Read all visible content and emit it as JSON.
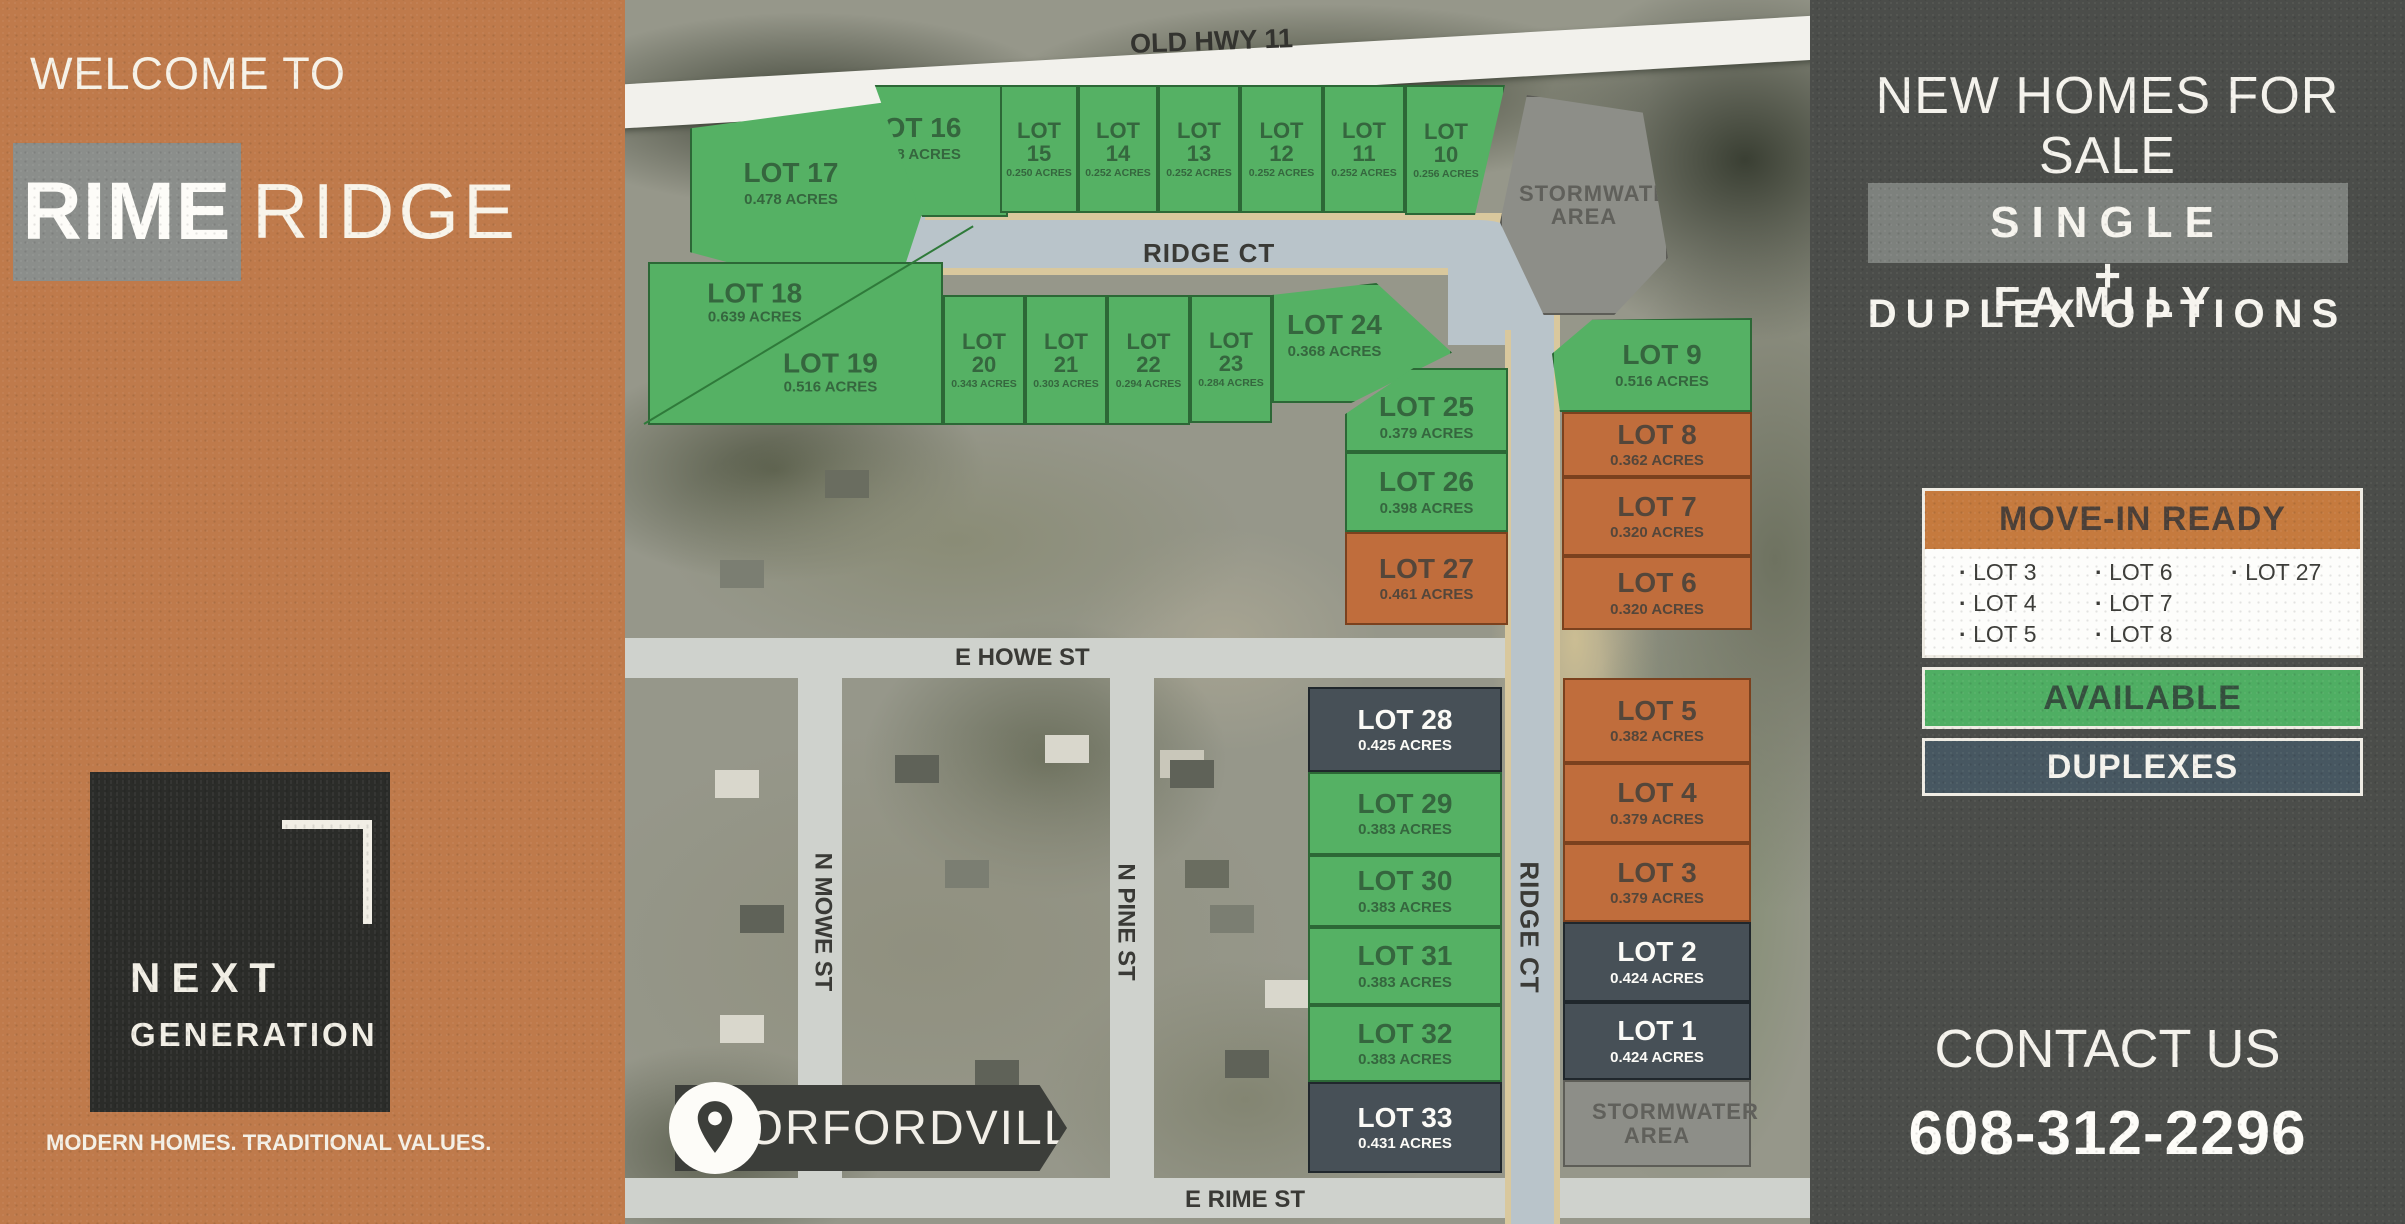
{
  "left_panel": {
    "welcome": "WELCOME TO",
    "brand_primary": "RIME",
    "brand_secondary": "RIDGE",
    "logo_line1": "NEXT",
    "logo_line2": "GENERATION",
    "tagline": "MODERN HOMES. TRADITIONAL VALUES."
  },
  "right_panel": {
    "headline": "NEW HOMES FOR SALE",
    "subhead_primary": "SINGLE FAMILY",
    "subhead_plus": "+",
    "subhead_secondary": "DUPLEX OPTIONS",
    "legend": {
      "move_in_ready": {
        "label": "MOVE-IN READY",
        "column1": [
          "LOT 3",
          "LOT 4",
          "LOT 5"
        ],
        "column2": [
          "LOT 6",
          "LOT 7",
          "LOT 8"
        ],
        "column3": [
          "LOT 27"
        ]
      },
      "available_label": "AVAILABLE",
      "duplexes_label": "DUPLEXES"
    },
    "contact": {
      "label": "CONTACT US",
      "phone": "608-312-2296"
    }
  },
  "map": {
    "streets": {
      "old_hwy": "OLD HWY 11",
      "ridge_ct_top": "RIDGE CT",
      "ridge_ct_side": "RIDGE CT",
      "e_howe": "E HOWE ST",
      "n_mowe": "N MOWE ST",
      "n_pine": "N PINE ST",
      "e_rime": "E RIME ST"
    },
    "town_badge": "ORFORDVILLE",
    "stormwater_top": "STORMWATER AREA",
    "stormwater_bottom": "STORMWATER AREA",
    "lots": {
      "lot1": {
        "name": "LOT 1",
        "acres": "0.424 ACRES",
        "status": "duplex"
      },
      "lot2": {
        "name": "LOT 2",
        "acres": "0.424 ACRES",
        "status": "duplex"
      },
      "lot3": {
        "name": "LOT 3",
        "acres": "0.379 ACRES",
        "status": "move-in-ready"
      },
      "lot4": {
        "name": "LOT 4",
        "acres": "0.379 ACRES",
        "status": "move-in-ready"
      },
      "lot5": {
        "name": "LOT 5",
        "acres": "0.382 ACRES",
        "status": "move-in-ready"
      },
      "lot6": {
        "name": "LOT 6",
        "acres": "0.320 ACRES",
        "status": "move-in-ready"
      },
      "lot7": {
        "name": "LOT 7",
        "acres": "0.320 ACRES",
        "status": "move-in-ready"
      },
      "lot8": {
        "name": "LOT 8",
        "acres": "0.362 ACRES",
        "status": "move-in-ready"
      },
      "lot9": {
        "name": "LOT 9",
        "acres": "0.516 ACRES",
        "status": "available"
      },
      "lot10": {
        "name": "LOT 10",
        "acres": "0.256 ACRES",
        "status": "available"
      },
      "lot11": {
        "name": "LOT 11",
        "acres": "0.252 ACRES",
        "status": "available"
      },
      "lot12": {
        "name": "LOT 12",
        "acres": "0.252 ACRES",
        "status": "available"
      },
      "lot13": {
        "name": "LOT 13",
        "acres": "0.252 ACRES",
        "status": "available"
      },
      "lot14": {
        "name": "LOT 14",
        "acres": "0.252 ACRES",
        "status": "available"
      },
      "lot15": {
        "name": "LOT 15",
        "acres": "0.250 ACRES",
        "status": "available"
      },
      "lot16": {
        "name": "LOT 16",
        "acres": "0.408 ACRES",
        "status": "available"
      },
      "lot17": {
        "name": "LOT 17",
        "acres": "0.478 ACRES",
        "status": "available"
      },
      "lot18": {
        "name": "LOT 18",
        "acres": "0.639 ACRES",
        "status": "available"
      },
      "lot19": {
        "name": "LOT 19",
        "acres": "0.516 ACRES",
        "status": "available"
      },
      "lot20": {
        "name": "LOT 20",
        "acres": "0.343 ACRES",
        "status": "available"
      },
      "lot21": {
        "name": "LOT 21",
        "acres": "0.303 ACRES",
        "status": "available"
      },
      "lot22": {
        "name": "LOT 22",
        "acres": "0.294 ACRES",
        "status": "available"
      },
      "lot23": {
        "name": "LOT 23",
        "acres": "0.284 ACRES",
        "status": "available"
      },
      "lot24": {
        "name": "LOT 24",
        "acres": "0.368 ACRES",
        "status": "available"
      },
      "lot25": {
        "name": "LOT 25",
        "acres": "0.379 ACRES",
        "status": "available"
      },
      "lot26": {
        "name": "LOT 26",
        "acres": "0.398 ACRES",
        "status": "available"
      },
      "lot27": {
        "name": "LOT 27",
        "acres": "0.461 ACRES",
        "status": "move-in-ready"
      },
      "lot28": {
        "name": "LOT 28",
        "acres": "0.425 ACRES",
        "status": "duplex"
      },
      "lot29": {
        "name": "LOT 29",
        "acres": "0.383 ACRES",
        "status": "available"
      },
      "lot30": {
        "name": "LOT 30",
        "acres": "0.383 ACRES",
        "status": "available"
      },
      "lot31": {
        "name": "LOT 31",
        "acres": "0.383 ACRES",
        "status": "available"
      },
      "lot32": {
        "name": "LOT 32",
        "acres": "0.383 ACRES",
        "status": "available"
      },
      "lot33": {
        "name": "LOT 33",
        "acres": "0.431 ACRES",
        "status": "duplex"
      }
    }
  },
  "colors": {
    "available_green": "#55b164",
    "move_in_orange": "#c06d3c",
    "duplex_slate": "#475057",
    "stormwater_gray": "#8d8e88",
    "panel_orange": "#bf7a4b",
    "panel_charcoal": "#4b4d4a",
    "road_blue_gray": "#b9c4ca",
    "road_tan_edge": "#d9c89d"
  }
}
